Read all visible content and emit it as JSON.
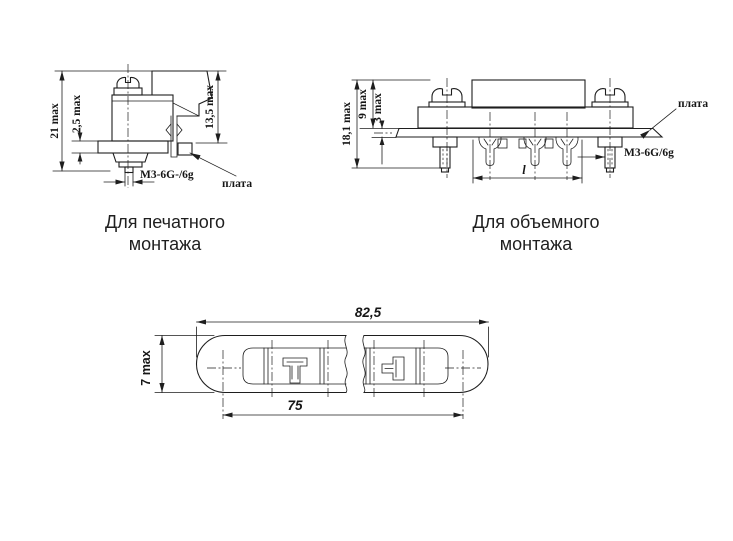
{
  "drawing_title": "connector mounting views",
  "colors": {
    "line": "#1e1e1e",
    "text": "#161616",
    "background": "#ffffff"
  },
  "pcb_view": {
    "dim_total_height": "21 max",
    "dim_flange_thickness": "2,5 max",
    "dim_above_board": "13,5 max",
    "thread_label": "М3-6G-/6g",
    "board_label": "плата",
    "caption_line1": "Для печатного",
    "caption_line2": "монтажа"
  },
  "wire_view": {
    "dim_total_height": "18,1 max",
    "dim_above_board": "9 max",
    "dim_board_thickness": "3 max",
    "dim_length": "l",
    "thread_label": "М3-6G/6g",
    "board_label": "плата",
    "caption_line1": "Для объемного",
    "caption_line2": "монтажа"
  },
  "top_view": {
    "dim_overall_length": "82,5",
    "dim_mounting_pitch": "75",
    "dim_width": "7 max"
  }
}
